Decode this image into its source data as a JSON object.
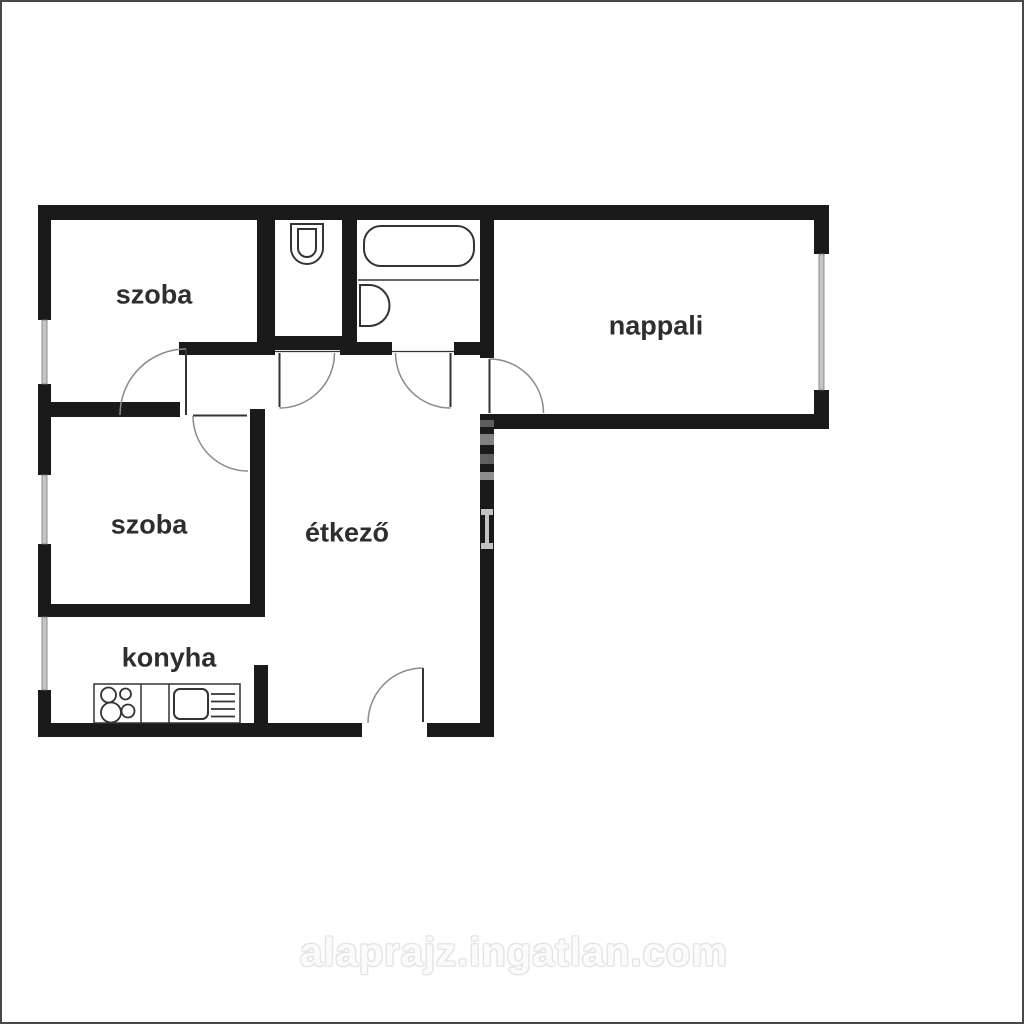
{
  "plan": {
    "title": "apartment-floor-plan",
    "rooms": [
      {
        "id": "szoba-1",
        "label": "szoba"
      },
      {
        "id": "nappali",
        "label": "nappali"
      },
      {
        "id": "szoba-2",
        "label": "szoba"
      },
      {
        "id": "etkezo",
        "label": "étkező"
      },
      {
        "id": "konyha",
        "label": "konyha"
      }
    ],
    "fixtures": [
      "toilet",
      "bathtub",
      "washbasin",
      "stove",
      "kitchen-sink",
      "drainboard"
    ],
    "watermark": "alaprajz.ingatlan.com",
    "colors": {
      "wall": "#1a1a1a",
      "line": "#333333",
      "arc": "#8a8a8a",
      "window_glass": "#c6c6c6",
      "label": "#2e2e2e",
      "background": "#ffffff",
      "frame": "#474747"
    }
  }
}
